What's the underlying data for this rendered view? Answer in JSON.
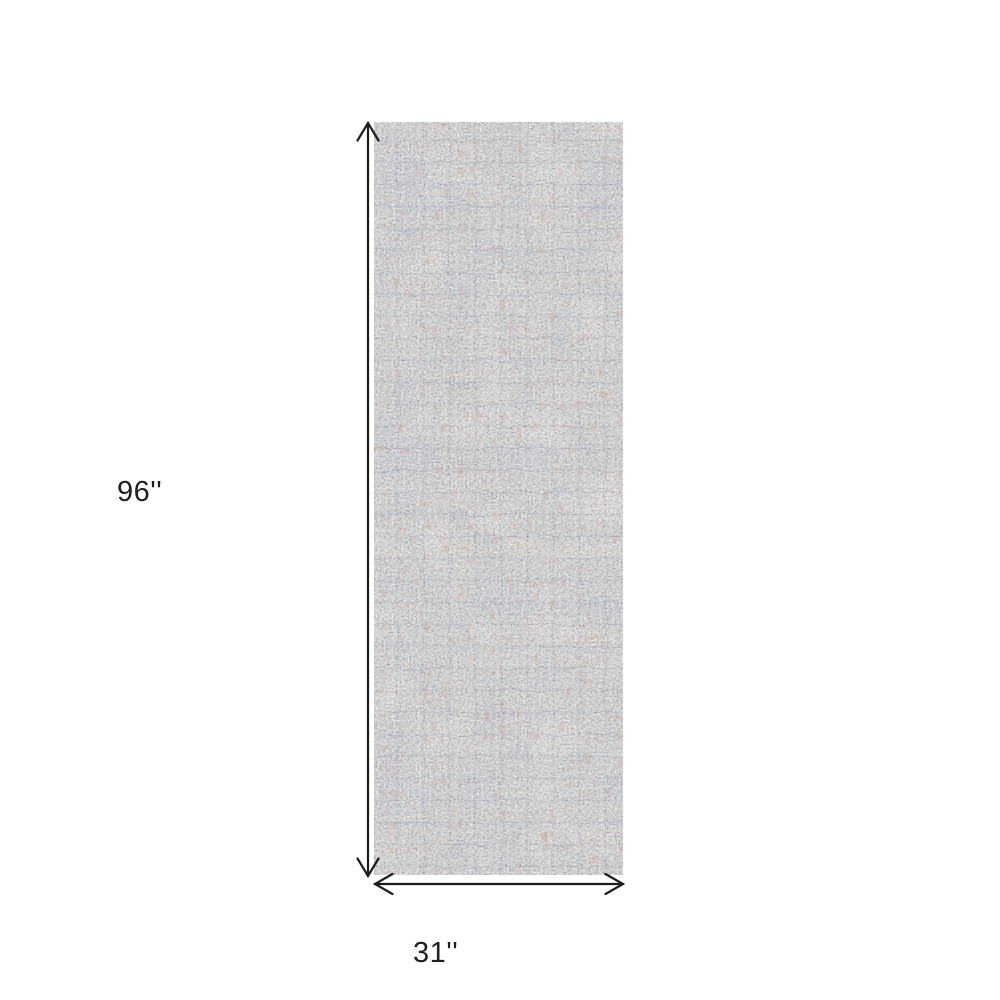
{
  "page": {
    "background_color": "#ffffff"
  },
  "product_diagram": {
    "kind": "rug-dimension-diagram",
    "height_label": "96''",
    "width_label": "31''",
    "arrow_color": "#1c1c1c",
    "label_color": "#1f1f1f",
    "rug": {
      "name": "distressed-abstract-runner-rug",
      "base_color": "#d6d2cc",
      "accent_blue_gray": "#8c99ad",
      "accent_slate": "#6b7588",
      "accent_beige": "#ece4d7",
      "accent_rust": "#9e5c4c",
      "accent_dark_fleck": "#2a3040",
      "accent_light_fleck": "#f4efe6"
    }
  }
}
